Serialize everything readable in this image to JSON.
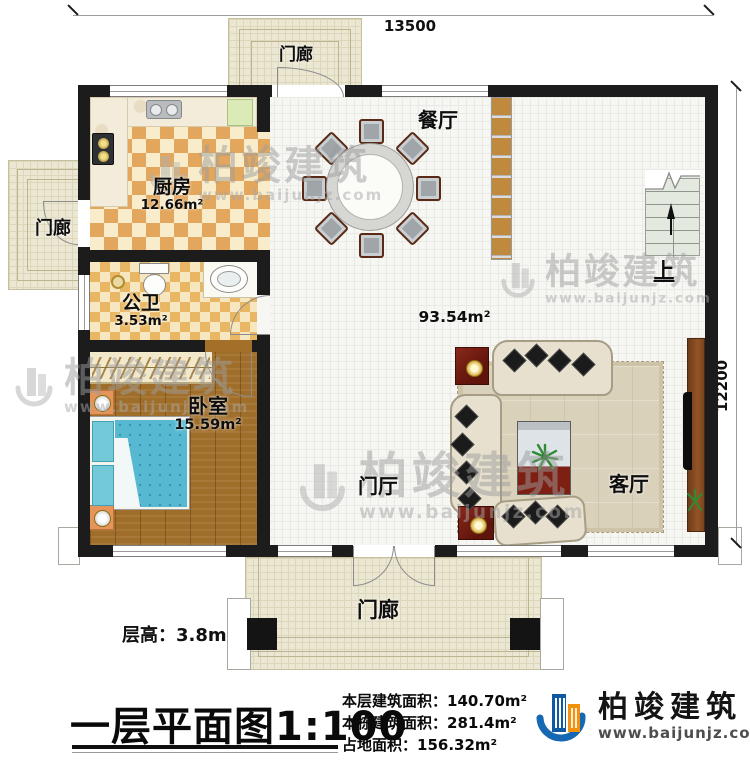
{
  "dimensions": {
    "top": "13500",
    "right": "12200"
  },
  "rooms": {
    "kitchen": {
      "name": "厨房",
      "area": "12.66m²"
    },
    "bath": {
      "name": "公卫",
      "area": "3.53m²"
    },
    "bedroom": {
      "name": "卧室",
      "area": "15.59m²"
    },
    "dining": {
      "name": "餐厅"
    },
    "living": {
      "name": "客厅"
    },
    "foyer": {
      "name": "门厅"
    },
    "porch_top": {
      "name": "门廊"
    },
    "porch_left": {
      "name": "门廊"
    },
    "porch_bottom": {
      "name": "门廊"
    },
    "open_area": {
      "area": "93.54m²"
    },
    "stairs": {
      "up_label": "上"
    }
  },
  "notes": {
    "floor_height": "层高：3.8m"
  },
  "title": {
    "text": "一层平面图",
    "scale": "1:100"
  },
  "stats": [
    {
      "label": "本层建筑面积：",
      "value": "140.70m²"
    },
    {
      "label": "本栋建筑面积：",
      "value": "281.4m²"
    },
    {
      "label": "占地面积：",
      "value": "156.32m²"
    }
  ],
  "brand": {
    "name": "柏竣建筑",
    "url": "www.baijunjz.com",
    "blue": "#1668b2",
    "orange": "#f2910d"
  },
  "watermark": {
    "name": "柏竣建筑",
    "url": "www.baijunjz.com"
  }
}
